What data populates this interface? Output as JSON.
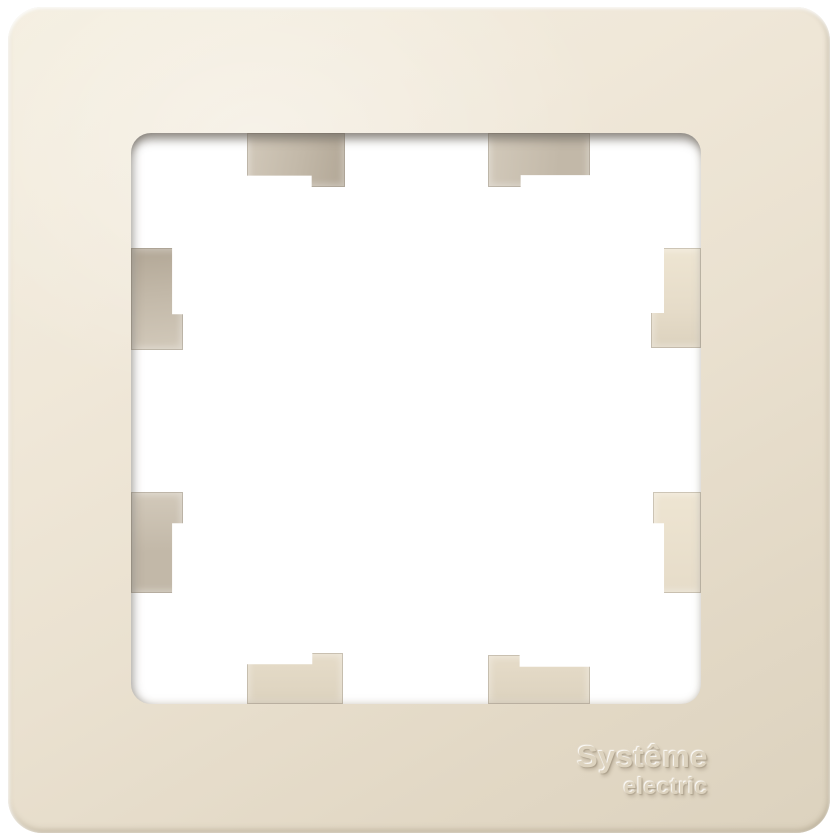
{
  "brand": {
    "line1": "Systême",
    "line2": "electric"
  },
  "colors": {
    "background": "#ffffff",
    "frame_light": "#f4eedf",
    "frame_mid": "#eae1d0",
    "frame_dark": "#dcd2be",
    "tab_taupe_light": "#d2c9ba",
    "tab_taupe": "#c2b8a8",
    "tab_taupe_deep": "#b2a796",
    "tab_cream_light": "#eee5d2",
    "tab_cream": "#e6dcc9",
    "tab_cream_deep": "#dcd2be",
    "logo_color": "#ddd3bf"
  }
}
